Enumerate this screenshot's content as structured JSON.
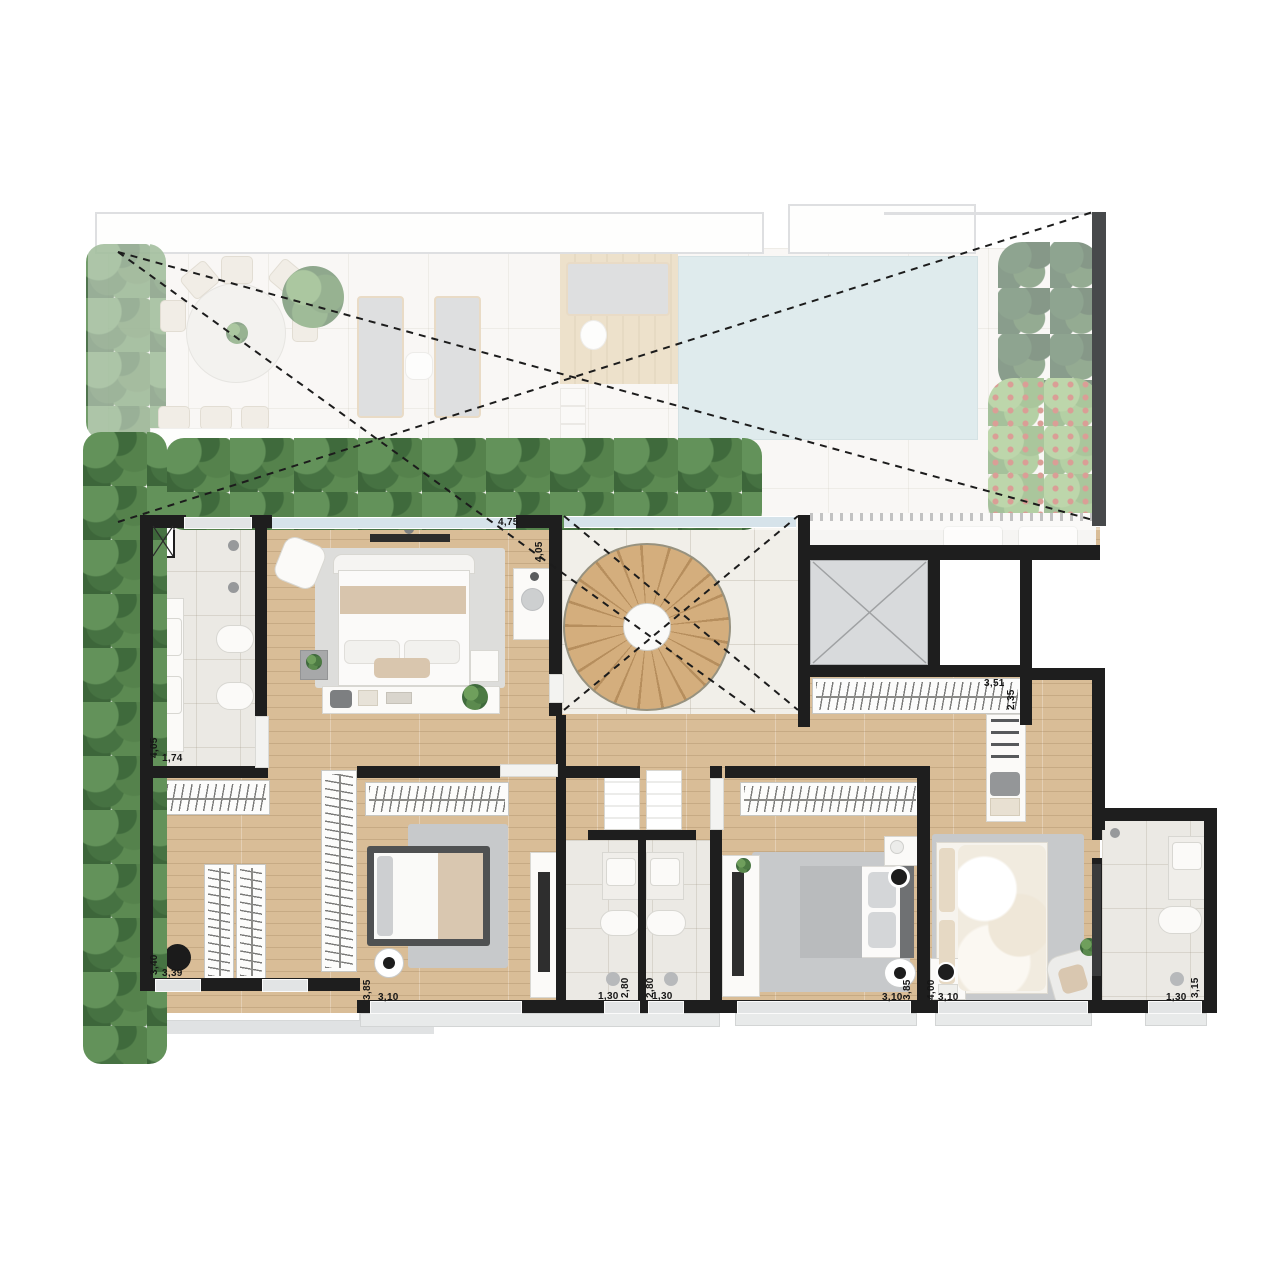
{
  "plan": {
    "name": "penthouse-upper-floor-plan",
    "colors": {
      "wall": "#1e1e1e",
      "wood_floor": "#d9bd97",
      "tile_floor": "#f1efe9",
      "bath_tile": "#ebe9e4",
      "terrace_floor": "#f4f2ee",
      "pool": "#c9dde0",
      "deck": "#dcc6a0",
      "hedge_green": "#4d7a45",
      "flower_red": "#c0584a",
      "rug_gray": "#c7c9cb",
      "elevator_gray": "#d8dadc"
    },
    "rooms": [
      {
        "id": "master-bathroom",
        "dims": {
          "w": "1,74",
          "h": "4,05"
        }
      },
      {
        "id": "master-bedroom",
        "dims": {
          "w": "4,75",
          "h": "4,05"
        }
      },
      {
        "id": "walk-in-closet",
        "dims": {
          "w": "3,39",
          "h": "3,40"
        }
      },
      {
        "id": "bedroom-2",
        "dims": {
          "w": "3,10",
          "h": "3,85"
        }
      },
      {
        "id": "bathroom-2",
        "dims": {
          "w": "1,30",
          "h": "2,80"
        }
      },
      {
        "id": "bathroom-3",
        "dims": {
          "w": "1,30",
          "h": "2,80"
        }
      },
      {
        "id": "bedroom-3",
        "dims": {
          "w": "3,10",
          "h": "3,85"
        }
      },
      {
        "id": "suite-4-bedroom",
        "dims": {
          "w": "3,10",
          "h": "4,00"
        }
      },
      {
        "id": "suite-4-closet",
        "dims": {
          "w": "3,51",
          "h": "2,35"
        }
      },
      {
        "id": "suite-4-bathroom",
        "dims": {
          "w": "1,30",
          "h": "3,15"
        }
      }
    ],
    "features": [
      "terrace",
      "swimming-pool",
      "wood-deck",
      "sun-loungers",
      "outdoor-dining-table",
      "planter-hedges",
      "spiral-staircase",
      "void-dashed-lines",
      "elevator-shaft",
      "duct-shaft",
      "king-bed",
      "beds",
      "wardrobe-racks",
      "toilets",
      "washbasins",
      "showers",
      "tv-panels",
      "armchairs",
      "balcony",
      "air-conditioning-units"
    ]
  }
}
